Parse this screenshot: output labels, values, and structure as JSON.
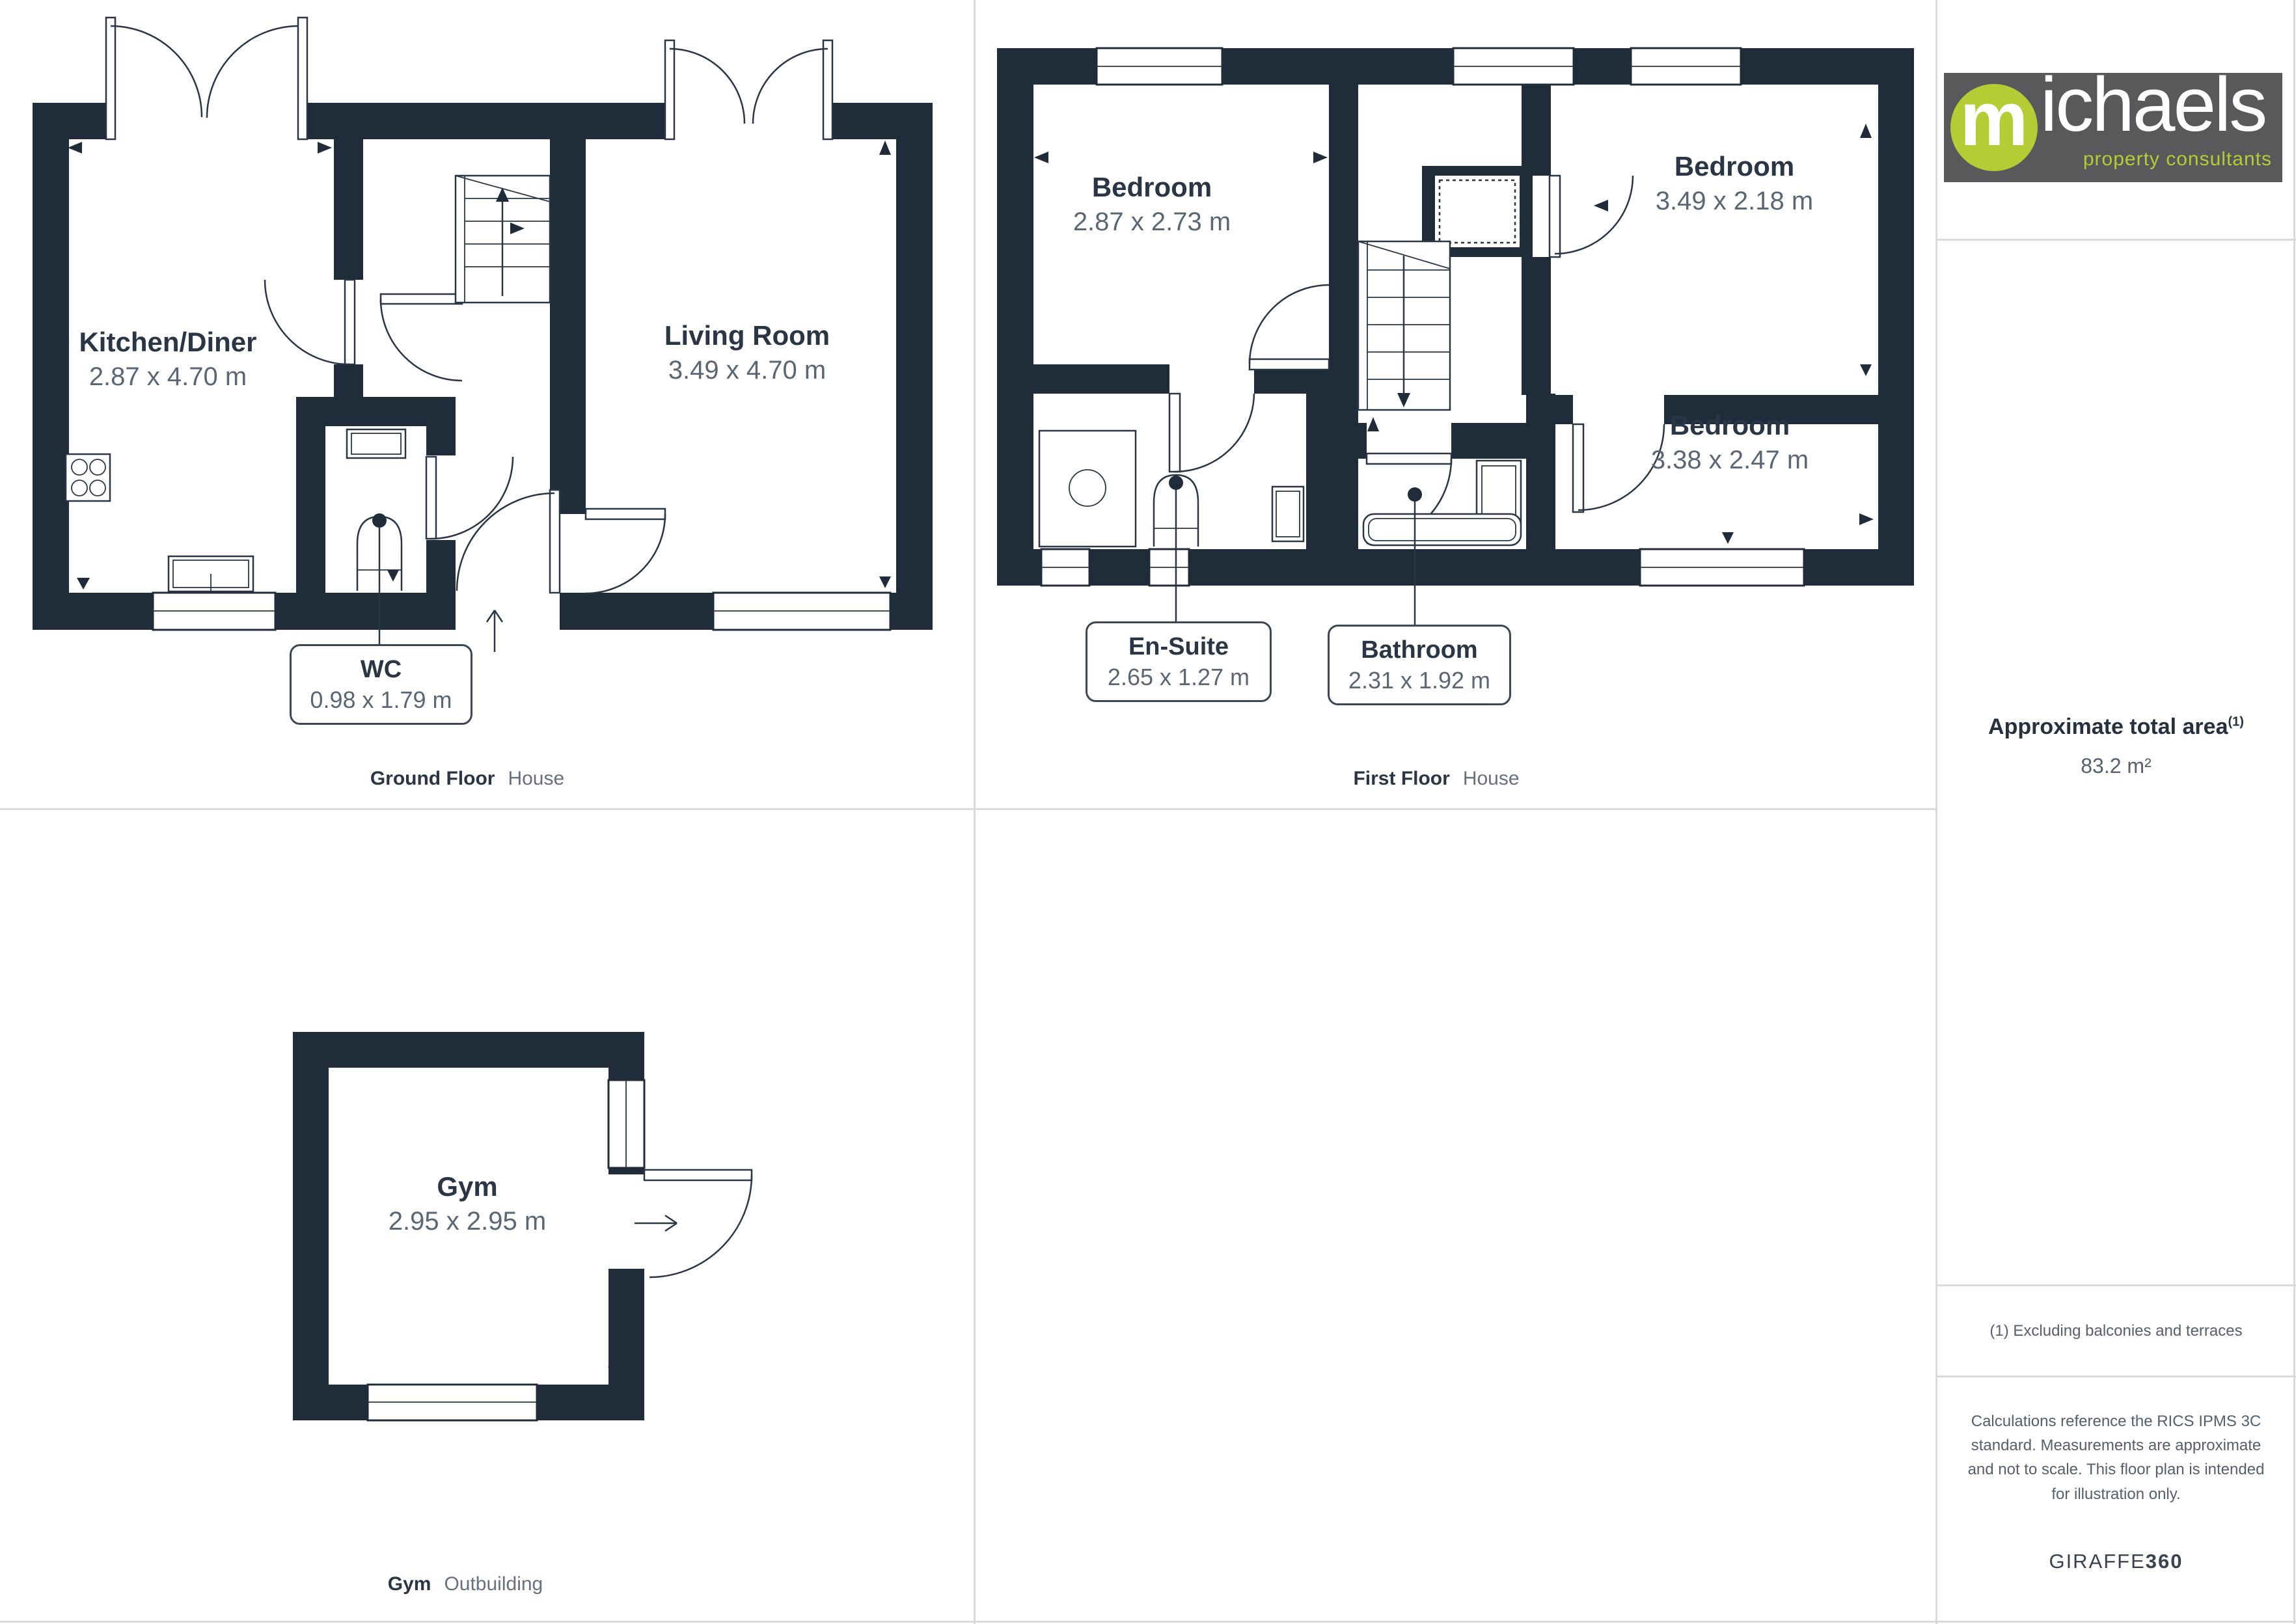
{
  "brand_logo": {
    "bg_color": "#58595a",
    "accent_color": "#b5cc34",
    "mark_letter": "m",
    "name_rest": "ichaels",
    "tagline": "property consultants"
  },
  "palette": {
    "wall": "#212c3a",
    "room_name_text": "#2a3646",
    "dimension_text": "#5b6675",
    "muted_text": "#66707e",
    "divider": "#d8dadb"
  },
  "floors": [
    {
      "caption": "Ground Floor",
      "building": "House",
      "rooms": [
        {
          "name": "Kitchen/Diner",
          "dims": "2.87 x 4.70 m"
        },
        {
          "name": "Living Room",
          "dims": "3.49 x 4.70 m"
        },
        {
          "name": "WC",
          "dims": "0.98 x 1.79 m"
        }
      ]
    },
    {
      "caption": "First Floor",
      "building": "House",
      "rooms": [
        {
          "name": "Bedroom",
          "dims": "2.87 x 2.73 m"
        },
        {
          "name": "Bedroom",
          "dims": "3.49 x 2.18 m"
        },
        {
          "name": "Bedroom",
          "dims": "3.38 x 2.47 m"
        },
        {
          "name": "En-Suite",
          "dims": "2.65 x 1.27 m"
        },
        {
          "name": "Bathroom",
          "dims": "2.31 x 1.92 m"
        }
      ]
    },
    {
      "caption": "Gym",
      "building": "Outbuilding",
      "rooms": [
        {
          "name": "Gym",
          "dims": "2.95 x 2.95 m"
        }
      ]
    }
  ],
  "sidebar": {
    "area_title": "Approximate total area",
    "area_footnote_marker": "(1)",
    "area_value": "83.2 m²",
    "footnote": "(1) Excluding balconies and terraces",
    "disclaimer": "Calculations reference the RICS IPMS 3C standard. Measurements are approximate and not to scale. This floor plan is intended for illustration only.",
    "brand_name": "GIRAFFE",
    "brand_suffix": "360"
  }
}
